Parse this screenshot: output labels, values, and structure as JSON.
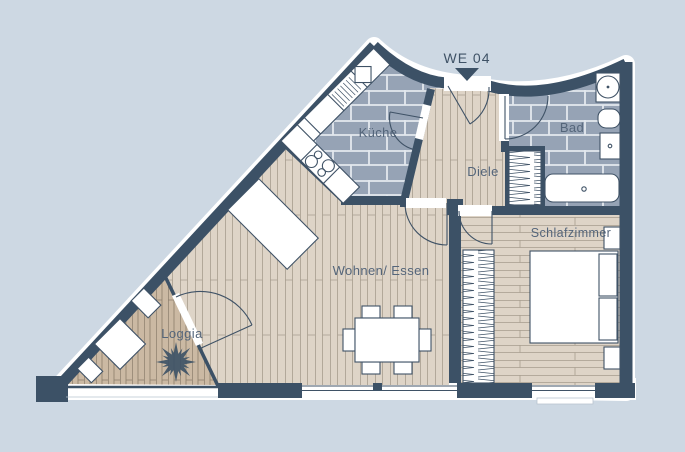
{
  "unit_label": "WE 04",
  "rooms": {
    "kueche": {
      "label": "Küche"
    },
    "bad": {
      "label": "Bad"
    },
    "diele": {
      "label": "Diele"
    },
    "schlafzimmer": {
      "label": "Schlafzimmer"
    },
    "wohnen_essen": {
      "label": "Wohnen/ Essen"
    },
    "loggia": {
      "label": "Loggia"
    }
  },
  "icons": {
    "entrance_marker": "triangle-down",
    "plant": "star-leaf",
    "stove": "four-burners",
    "wardrobe": "zigzag-rail",
    "bathtub": "rounded-tub",
    "toilet": "wc-oval",
    "washbasin": "circle-in-square",
    "sink": "square-with-drain"
  },
  "colors": {
    "background": "#cdd8e3",
    "halo": "#ffffff",
    "wall": "#3c5166",
    "tile": "#96a3b5",
    "tile_line": "#e3e8ee",
    "wood": "#ded4c7",
    "wood_line": "#a79d8e",
    "loggia_wood": "#cbb9a3",
    "loggia_line": "#8b7d6b",
    "furniture": "#ffffff",
    "outline": "#3f5266",
    "label": "#54657a",
    "sill": "#b9c4cf"
  }
}
